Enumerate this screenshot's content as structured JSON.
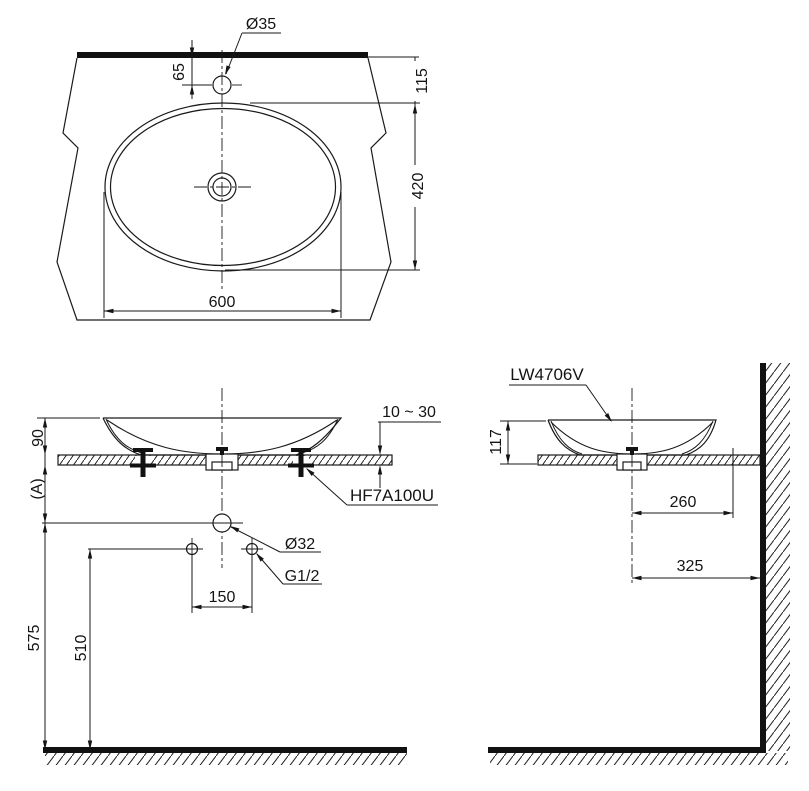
{
  "drawing": {
    "plan_view": {
      "faucet_hole_dia": "Ø35",
      "faucet_offset": "65",
      "wall_to_bowl_top": "115",
      "bowl_depth": "420",
      "bowl_width": "600"
    },
    "front_view": {
      "rim_height": "90",
      "counter_to_drain": "(A)",
      "counter_thickness": "10 ~ 30",
      "bracket_code": "HF7A100U",
      "drain_dia": "Ø32",
      "supply_thread": "G1/2",
      "supply_spacing": "150",
      "floor_to_drain": "575",
      "floor_to_supply": "510"
    },
    "side_view": {
      "model_code": "LW4706V",
      "basin_height": "117",
      "center_to_hole": "260",
      "center_to_wall": "325"
    }
  }
}
